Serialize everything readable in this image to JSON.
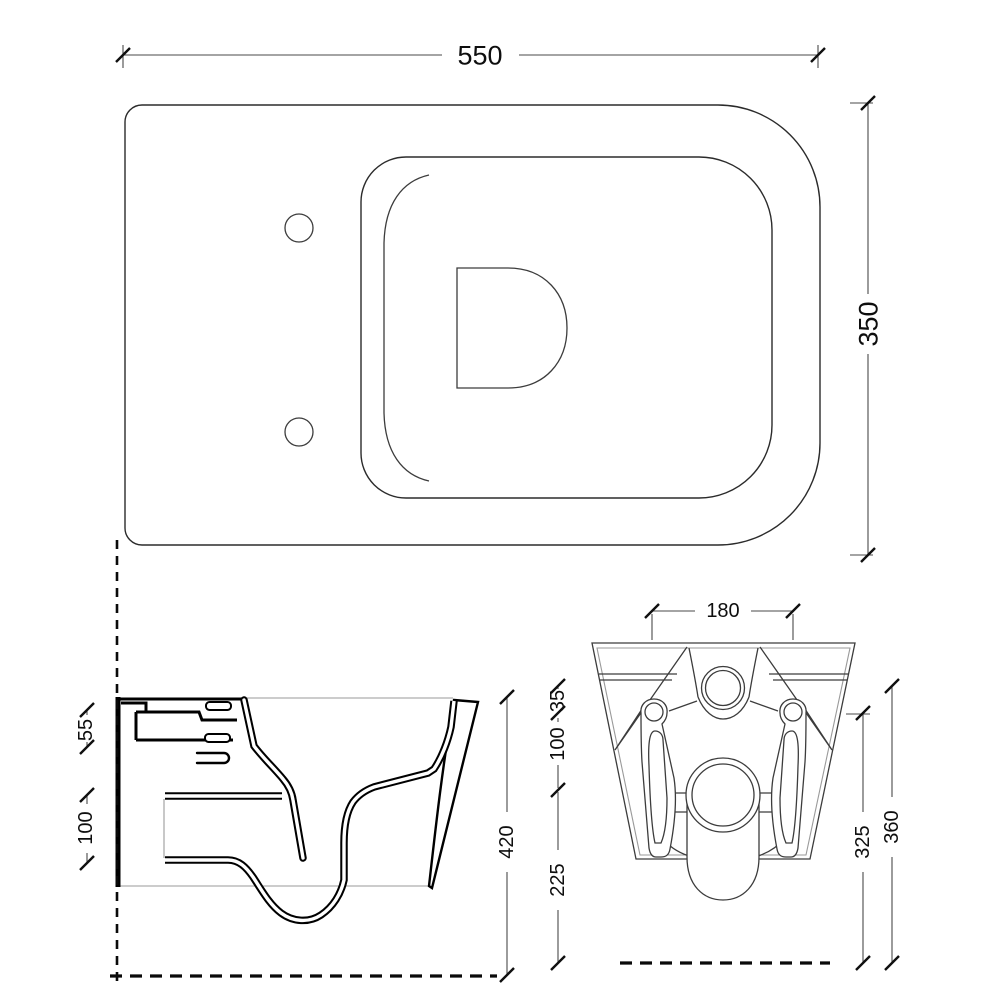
{
  "page": {
    "background": "#ffffff",
    "description": "Technical dimension drawing of a wall-hung toilet: plan view, side section view and rear view"
  },
  "style": {
    "line_color": "#000000",
    "dim_line_color": "#4a4a4a",
    "text_color": "#0e0e0e"
  },
  "dims": {
    "plan_width": "550",
    "plan_depth": "350",
    "side_top": "55",
    "side_opening": "100",
    "side_height": "420",
    "rear_width": "180",
    "rear_inlet_drop": "35",
    "rear_fix_drop": "100",
    "rear_outlet_height": "225",
    "rear_fix_height": "325",
    "rear_inlet_height": "360"
  }
}
